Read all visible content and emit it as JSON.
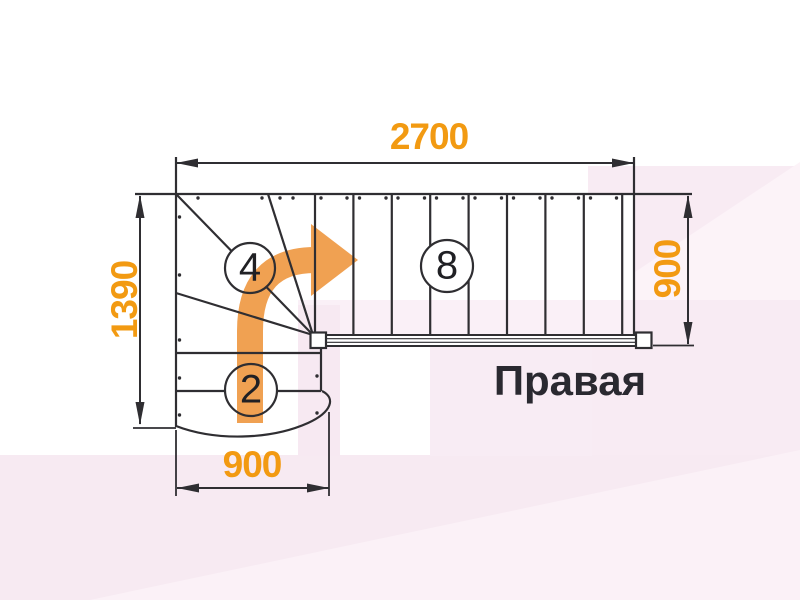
{
  "plan": {
    "title": "Правая",
    "dimensions": {
      "top": "2700",
      "left": "1390",
      "right": "900",
      "bottom": "900"
    },
    "step_counts": {
      "winder": "4",
      "upper_flight": "8",
      "lower_flight": "2"
    }
  },
  "colors": {
    "dimension_text": "#F29A12",
    "arrow": "#F0A152",
    "linework": "#2F2E32",
    "background_tint": "#F7EAF2"
  }
}
